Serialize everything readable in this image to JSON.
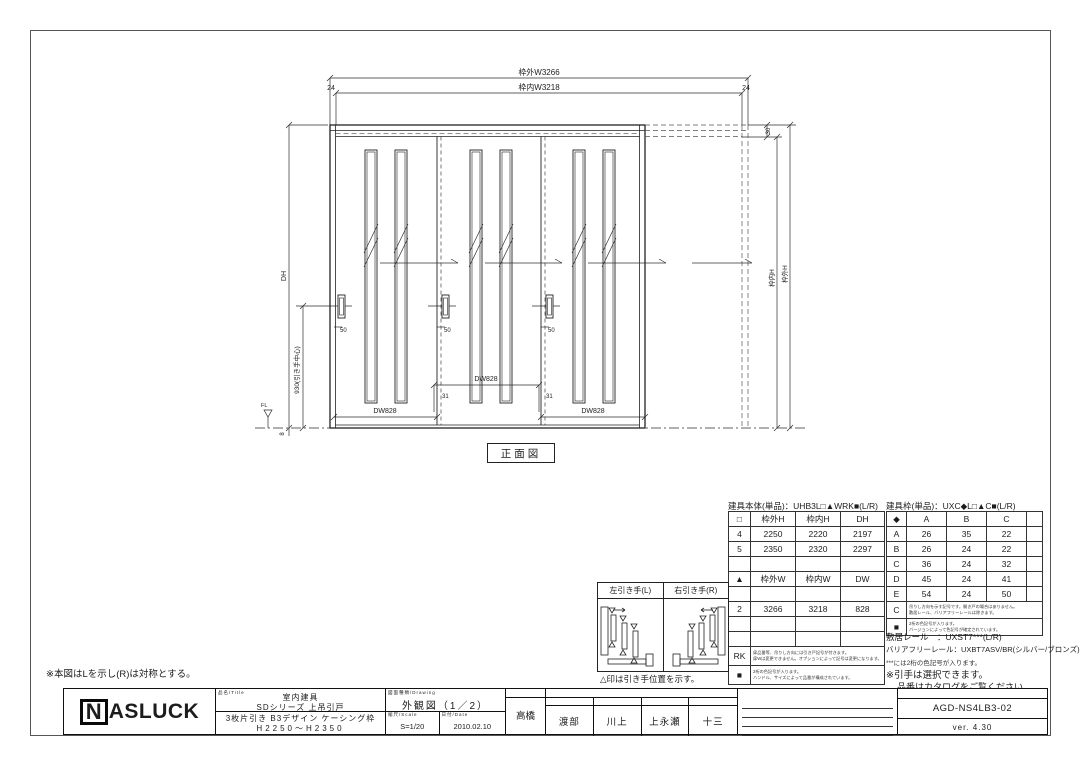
{
  "colors": {
    "line": "#2e2e2e",
    "background": "#ffffff"
  },
  "sheet": {
    "mirror_note": "※本図はLを示し(R)は対称とする。",
    "view_label": "正面図"
  },
  "drawing": {
    "outer_w": "枠外W3266",
    "inner_w": "枠内W3218",
    "margin_left": "24",
    "margin_right": "24",
    "top_rail": "30",
    "dh": "DH",
    "handle_center": "930(引き手中心)",
    "inner_h": "枠内H",
    "outer_h": "枠外H",
    "fl": "FL",
    "floor_gap": "8",
    "dw1": "DW828",
    "dw2": "DW828",
    "dw3": "DW828",
    "overlap1": "31",
    "overlap2": "31",
    "offset1": "50",
    "offset2": "50",
    "offset3": "50"
  },
  "body_table": {
    "title": "建具本体(単品)：UHB3L□▲WRK■(L/R)",
    "rows": [
      [
        "□",
        "枠外H",
        "枠内H",
        "DH"
      ],
      [
        "4",
        "2250",
        "2220",
        "2197"
      ],
      [
        "5",
        "2350",
        "2320",
        "2297"
      ],
      [
        "",
        "",
        "",
        ""
      ],
      [
        "▲",
        "枠外W",
        "枠内W",
        "DW"
      ],
      [
        "",
        "",
        "",
        ""
      ],
      [
        "2",
        "3266",
        "3218",
        "828"
      ],
      [
        "",
        "",
        "",
        ""
      ],
      [
        "",
        "",
        "",
        ""
      ]
    ],
    "note_rows": [
      {
        "key": "RK",
        "line1": "扉品番等、吊りし方向には引き戸記号が付きます。",
        "line2": "扉Wは変更できません。オプションによって記号は変更になります。"
      },
      {
        "key": "■",
        "line1": "2桁の色記号が入ります。",
        "line2": "ハンドル、サイズによって品番が構成されています。"
      }
    ]
  },
  "frame_table": {
    "title": "建具枠(単品)：UXC◆L□▲C■(L/R)",
    "rows": [
      [
        "◆",
        "A",
        "B",
        "C",
        ""
      ],
      [
        "A",
        "26",
        "35",
        "22",
        ""
      ],
      [
        "B",
        "26",
        "24",
        "22",
        ""
      ],
      [
        "C",
        "36",
        "24",
        "32",
        ""
      ],
      [
        "D",
        "45",
        "24",
        "41",
        ""
      ],
      [
        "E",
        "54",
        "24",
        "50",
        ""
      ]
    ],
    "note_rows": [
      {
        "key": "C",
        "line1": "吊りし方向を示す記号です。開き戸の場合はありません。",
        "line2": "敷居レール、バリアフリーレールは除きます。"
      },
      {
        "key": "■",
        "line1": "2桁の色記号が入ります。",
        "line2": "バージョンによって色記号が確定されています。"
      }
    ]
  },
  "frame_notes": {
    "sill_rail": "敷居レール　：UXST7***(L/R)",
    "barrier_free_rail": "バリアフリーレール：UXBT7ASV/BR(シルバー/ブロンズ)",
    "color_code_note": "***には2桁の色記号が入ります。",
    "handle_note1": "※引手は選択できます。",
    "handle_note2": "品番はカタログをご覧ください。"
  },
  "handle_table": {
    "left_header": "左引き手(L)",
    "right_header": "右引き手(R)",
    "caption": "△印は引き手位置を示す。"
  },
  "title_block": {
    "logo_n": "N",
    "logo_rest": "ASLUCK",
    "name_label": "品名/Title",
    "product_category": "室内建具",
    "product_series": "SDシリーズ 上吊引戸",
    "product_spec": "3枚片引き B3デザイン ケーシング枠",
    "product_height": "H2250〜H2350",
    "drawing_label": "図面種類/Drawing",
    "drawing_type": "外観図（1／2）",
    "scale_label": "縮尺/Scale",
    "scale_value": "S=1/20",
    "date_label": "日付/Date",
    "date_value": "2010.02.10",
    "approval_label": "承認",
    "approver": "高橋",
    "check_label": "検査者/Check up by ナスラック㈱ダンシステム工業",
    "checkers": [
      {
        "label": "検図3",
        "name": "渡部"
      },
      {
        "label": "検図2",
        "name": "川上"
      },
      {
        "label": "検図1",
        "name": "上永瀬"
      },
      {
        "label": "作図",
        "name": "十三"
      }
    ],
    "history_label": "履歴/History",
    "number_label": "図面番号/No.",
    "drawing_number": "AGD-NS4LB3-02",
    "version": "ver. 4.30"
  }
}
